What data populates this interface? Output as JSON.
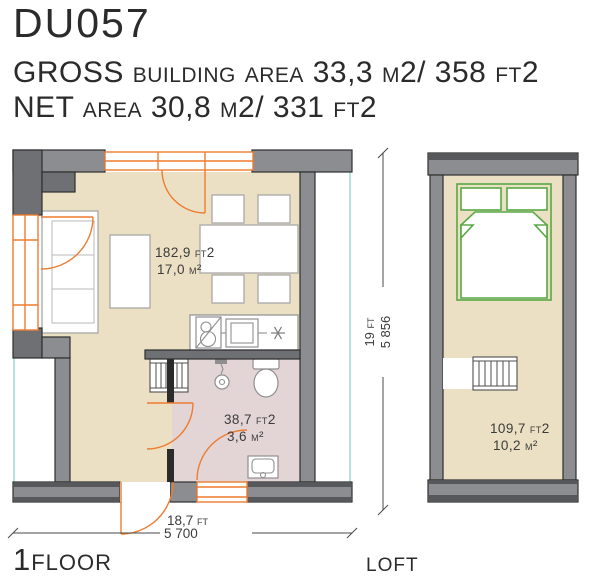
{
  "header": {
    "title": "DU057",
    "gross_area_line": "GROSS building area 33,3 m2/ 358 ft2",
    "net_area_line": "NET area 30,8 m2/ 331 ft2"
  },
  "floor1": {
    "label": "1floor",
    "living_room_area_ft2": "182,9 ft2",
    "living_room_area_m2": "17,0 m²",
    "bathroom_area_ft2": "38,7 ft2",
    "bathroom_area_m2": "3,6 m²",
    "width_ft": "18,7 ft",
    "width_mm": "5 700",
    "height_ft": "19 ft",
    "height_mm": "5 856"
  },
  "loft": {
    "label": "loft",
    "room_area_ft2": "109,7 ft2",
    "room_area_m2": "10,2 m²"
  },
  "colors": {
    "floor": "#ebe0c4",
    "bathroom_floor": "#e3d5d6",
    "wall_gray": "#8b8d90",
    "wall_dark_gray": "#6e7073",
    "accent_orange": "#ed7c31",
    "accent_green": "#58a846",
    "accent_teal": "#9ed9d6"
  }
}
